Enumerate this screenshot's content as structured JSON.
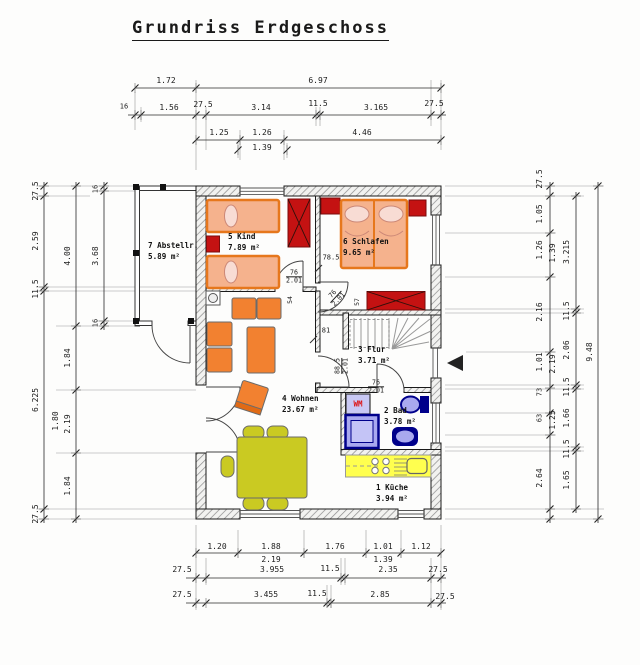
{
  "title": "Grundriss Erdgeschoss",
  "rooms": [
    {
      "label": "7 Abstellr.",
      "area": "5.89 m²",
      "x": 148,
      "y": 240
    },
    {
      "label": "5 Kind",
      "area": "7.89 m²",
      "x": 228,
      "y": 231
    },
    {
      "label": "6 Schlafen",
      "area": "9.65 m²",
      "x": 343,
      "y": 236
    },
    {
      "label": "3 Flur",
      "area": "3.71 m²",
      "x": 358,
      "y": 344
    },
    {
      "label": "4 Wohnen",
      "area": "23.67 m²",
      "x": 282,
      "y": 393
    },
    {
      "label": "2 Bad",
      "area": "3.78 m²",
      "x": 384,
      "y": 405
    },
    {
      "label": "1 Küche",
      "area": "3.94 m²",
      "x": 376,
      "y": 482
    }
  ],
  "labels": [
    {
      "s": "1.72",
      "x": 166,
      "y": 81
    },
    {
      "s": "6.97",
      "x": 318,
      "y": 81
    },
    {
      "s": "16",
      "x": 124,
      "y": 107,
      "fs": 7
    },
    {
      "s": "1.56",
      "x": 169,
      "y": 108
    },
    {
      "s": "27.5",
      "x": 203,
      "y": 105
    },
    {
      "s": "3.14",
      "x": 261,
      "y": 108
    },
    {
      "s": "11.5",
      "x": 318,
      "y": 104
    },
    {
      "s": "3.165",
      "x": 376,
      "y": 108
    },
    {
      "s": "27.5",
      "x": 434,
      "y": 104
    },
    {
      "s": "1.25",
      "x": 219,
      "y": 133
    },
    {
      "s": "1.26",
      "x": 262,
      "y": 133
    },
    {
      "s": "4.46",
      "x": 362,
      "y": 133
    },
    {
      "s": "1.39",
      "x": 262,
      "y": 148
    },
    {
      "s": "27.5",
      "x": 36,
      "y": 191,
      "r": -90
    },
    {
      "s": "2.59",
      "x": 36,
      "y": 241,
      "r": -90
    },
    {
      "s": "11.5",
      "x": 36,
      "y": 289,
      "r": -90
    },
    {
      "s": "6.225",
      "x": 36,
      "y": 400,
      "r": -90
    },
    {
      "s": "27.5",
      "x": 36,
      "y": 514,
      "r": -90
    },
    {
      "s": "4.00",
      "x": 68,
      "y": 256,
      "r": -90
    },
    {
      "s": "1.84",
      "x": 68,
      "y": 358,
      "r": -90
    },
    {
      "s": "1.80",
      "x": 56,
      "y": 421,
      "r": -90
    },
    {
      "s": "2.19",
      "x": 68,
      "y": 424,
      "r": -90
    },
    {
      "s": "1.84",
      "x": 68,
      "y": 486,
      "r": -90
    },
    {
      "s": "16",
      "x": 96,
      "y": 189,
      "r": -90,
      "fs": 7
    },
    {
      "s": "3.68",
      "x": 96,
      "y": 256,
      "r": -90
    },
    {
      "s": "16",
      "x": 96,
      "y": 323,
      "r": -90,
      "fs": 7
    },
    {
      "s": "27.5",
      "x": 540,
      "y": 179,
      "r": -90
    },
    {
      "s": "1.05",
      "x": 540,
      "y": 214,
      "r": -90
    },
    {
      "s": "1.26",
      "x": 540,
      "y": 250,
      "r": -90
    },
    {
      "s": "1.39",
      "x": 553,
      "y": 253,
      "r": -90
    },
    {
      "s": "2.16",
      "x": 540,
      "y": 312,
      "r": -90
    },
    {
      "s": "1.01",
      "x": 540,
      "y": 362,
      "r": -90
    },
    {
      "s": "2.19",
      "x": 553,
      "y": 364,
      "r": -90
    },
    {
      "s": "73",
      "x": 540,
      "y": 392,
      "r": -90,
      "fs": 7
    },
    {
      "s": "63",
      "x": 540,
      "y": 418,
      "r": -90,
      "fs": 7
    },
    {
      "s": "1.25",
      "x": 553,
      "y": 420,
      "r": -90
    },
    {
      "s": "2.64",
      "x": 540,
      "y": 478,
      "r": -90
    },
    {
      "s": "3.215",
      "x": 567,
      "y": 252,
      "r": -90
    },
    {
      "s": "11.5",
      "x": 567,
      "y": 311,
      "r": -90
    },
    {
      "s": "2.06",
      "x": 567,
      "y": 350,
      "r": -90
    },
    {
      "s": "11.5",
      "x": 567,
      "y": 387,
      "r": -90
    },
    {
      "s": "1.66",
      "x": 567,
      "y": 418,
      "r": -90
    },
    {
      "s": "11.5",
      "x": 567,
      "y": 449,
      "r": -90
    },
    {
      "s": "1.65",
      "x": 567,
      "y": 480,
      "r": -90
    },
    {
      "s": "9.48",
      "x": 590,
      "y": 352,
      "r": -90
    },
    {
      "s": "1.20",
      "x": 217,
      "y": 547
    },
    {
      "s": "1.88",
      "x": 271,
      "y": 547
    },
    {
      "s": "1.76",
      "x": 335,
      "y": 547
    },
    {
      "s": "1.01",
      "x": 383,
      "y": 547
    },
    {
      "s": "1.12",
      "x": 421,
      "y": 547
    },
    {
      "s": "2.19",
      "x": 271,
      "y": 560
    },
    {
      "s": "1.39",
      "x": 383,
      "y": 560
    },
    {
      "s": "27.5",
      "x": 182,
      "y": 570
    },
    {
      "s": "3.955",
      "x": 272,
      "y": 570
    },
    {
      "s": "11.5",
      "x": 330,
      "y": 569
    },
    {
      "s": "2.35",
      "x": 388,
      "y": 570
    },
    {
      "s": "27.5",
      "x": 438,
      "y": 570
    },
    {
      "s": "27.5",
      "x": 182,
      "y": 595
    },
    {
      "s": "3.455",
      "x": 266,
      "y": 595
    },
    {
      "s": "11.5",
      "x": 317,
      "y": 594
    },
    {
      "s": "2.85",
      "x": 380,
      "y": 595
    },
    {
      "s": "27.5",
      "x": 445,
      "y": 597
    },
    {
      "s": "78.5",
      "x": 331,
      "y": 258,
      "fs": 7
    },
    {
      "s": "54",
      "x": 290,
      "y": 300,
      "r": -90,
      "fs": 6.5
    },
    {
      "s": "57",
      "x": 357,
      "y": 302,
      "r": -90,
      "fs": 6.5
    },
    {
      "s": "81",
      "x": 326,
      "y": 331,
      "fs": 7
    },
    {
      "s": "WM",
      "x": 358,
      "y": 404,
      "fs": 7.5,
      "c": "#dd1111",
      "b": true
    }
  ],
  "fracs": [
    {
      "top": "76",
      "bot": "2.01",
      "x": 294,
      "y": 277
    },
    {
      "top": "76",
      "bot": "2.01",
      "x": 336,
      "y": 297,
      "r": -47
    },
    {
      "top": "88.5",
      "bot": "2.01",
      "x": 342,
      "y": 366,
      "r": -90
    },
    {
      "top": "76",
      "bot": "2.01",
      "x": 376,
      "y": 387
    }
  ]
}
